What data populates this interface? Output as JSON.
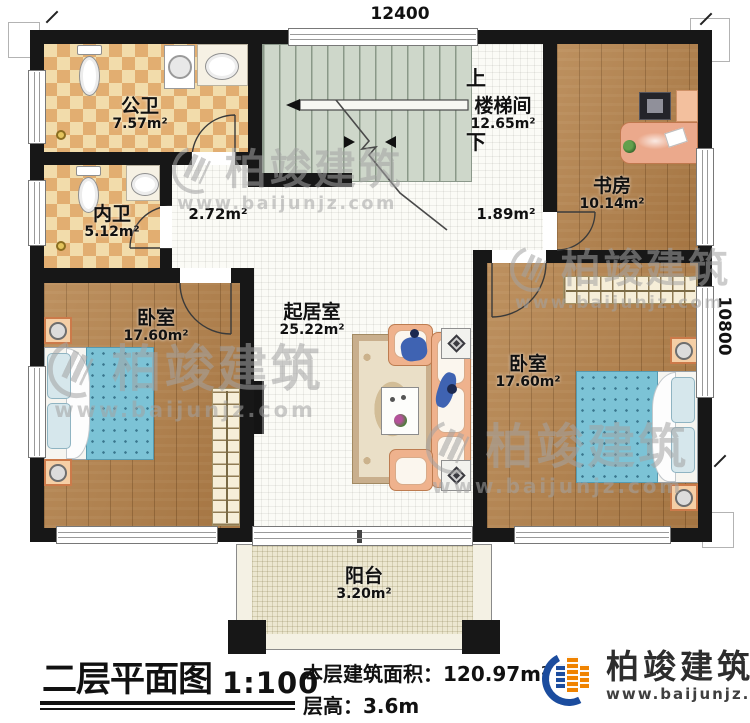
{
  "dimensions": {
    "top": "12400",
    "right": "10800"
  },
  "rooms": {
    "public_bath": {
      "name": "公卫",
      "area": "7.57m²"
    },
    "inner_bath": {
      "name": "内卫",
      "area": "5.12m²"
    },
    "stairwell": {
      "name": "楼梯间",
      "area": "12.65m²"
    },
    "study": {
      "name": "书房",
      "area": "10.14m²"
    },
    "bedroom_left": {
      "name": "卧室",
      "area": "17.60m²"
    },
    "living": {
      "name": "起居室",
      "area": "25.22m²"
    },
    "bedroom_right": {
      "name": "卧室",
      "area": "17.60m²"
    },
    "balcony": {
      "name": "阳台",
      "area": "3.20m²"
    }
  },
  "passages": {
    "hall_left": "2.72m²",
    "hall_right": "1.89m²"
  },
  "stairs": {
    "up": "上",
    "down": "下"
  },
  "title_block": {
    "title": "二层平面图",
    "scale": "1:100",
    "area_label": "本层建筑面积：",
    "area_value": "120.97m²",
    "floor_height_label": "层高：",
    "floor_height_value": "3.6m"
  },
  "brand": {
    "name": "柏竣建筑",
    "site": "www.baijunjz.com"
  },
  "colors": {
    "wall": "#171717",
    "wood_floor": "#b2804a",
    "tile_dark": "#e2ae71",
    "tile_light": "#f2dcab",
    "stair": "#ced7ca",
    "bed_blanket": "#7cc3d6",
    "sofa": "#efb28d",
    "balcony": "#ece7d0",
    "brand_blue": "#1b4c9e",
    "brand_orange": "#f08300"
  }
}
